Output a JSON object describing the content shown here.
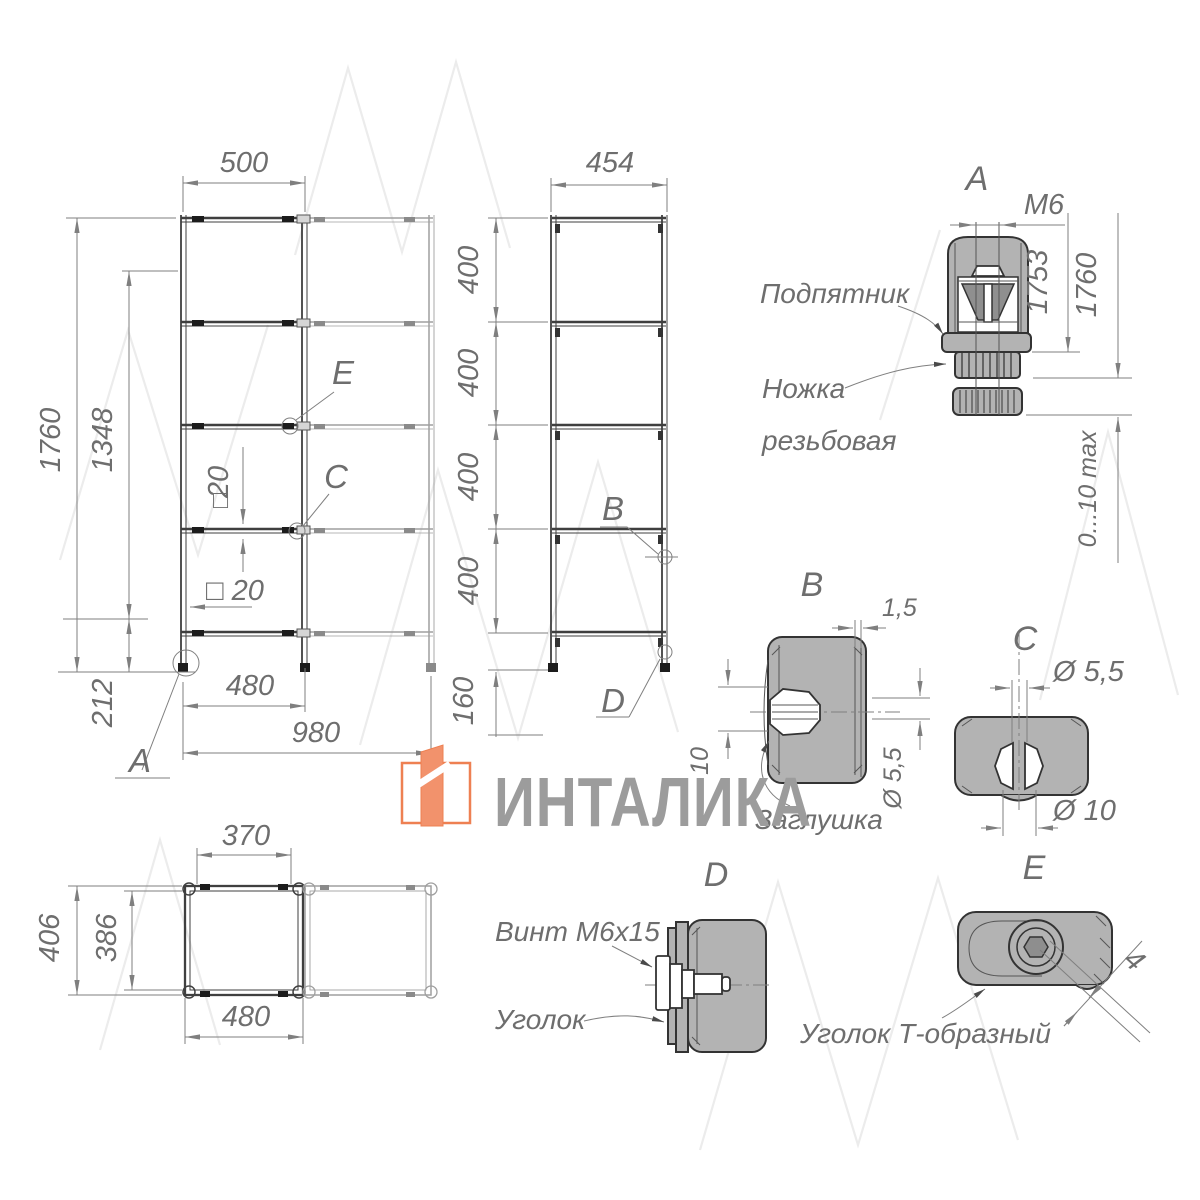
{
  "colors": {
    "background": "#ffffff",
    "drawing_line": "#3f3f3f",
    "light_line": "#9f9f9f",
    "dimension": "#7f7f7f",
    "detail_fill": "#b3b3b3",
    "watermark": "#ececec",
    "logo_accent": "#ee8052",
    "logo_text": "#9c9c9c"
  },
  "logo": {
    "brand": "ИНТАЛИКА"
  },
  "front_view": {
    "dim_500": "500",
    "dim_1760": "1760",
    "dim_1348": "1348",
    "dim_212": "212",
    "dim_sq20_v_num": "20",
    "dim_sq20_v_sq": "□",
    "dim_sq20_h": "□ 20",
    "dim_480": "480",
    "dim_980": "980",
    "callout_a": "A",
    "callout_c": "C",
    "callout_e": "E"
  },
  "side_view": {
    "dim_454": "454",
    "dim_400": "400",
    "dim_160": "160",
    "callout_b": "B",
    "callout_d": "D"
  },
  "detail_a": {
    "title": "A",
    "dim_m6": "M6",
    "dim_1753": "1753",
    "dim_1760": "1760",
    "dim_adjust": "0...10 max",
    "label_footplate": "Подпятник",
    "label_leg_line1": "Ножка",
    "label_leg_line2": "резьбовая"
  },
  "detail_b": {
    "title": "B",
    "dim_wall": "1,5",
    "dim_d55": "Ø 5,5",
    "dim_10": "10",
    "label_plug": "Заглушка"
  },
  "detail_c": {
    "title": "C",
    "dim_d55": "Ø 5,5",
    "dim_d10": "Ø 10"
  },
  "top_view": {
    "dim_370": "370",
    "dim_406": "406",
    "dim_386": "386",
    "dim_480": "480"
  },
  "detail_d": {
    "title": "D",
    "label_screw": "Винт M6x15",
    "label_bracket": "Уголок"
  },
  "detail_e": {
    "title": "E",
    "dim_4": "4",
    "label_bracket": "Уголок Т-образный"
  }
}
